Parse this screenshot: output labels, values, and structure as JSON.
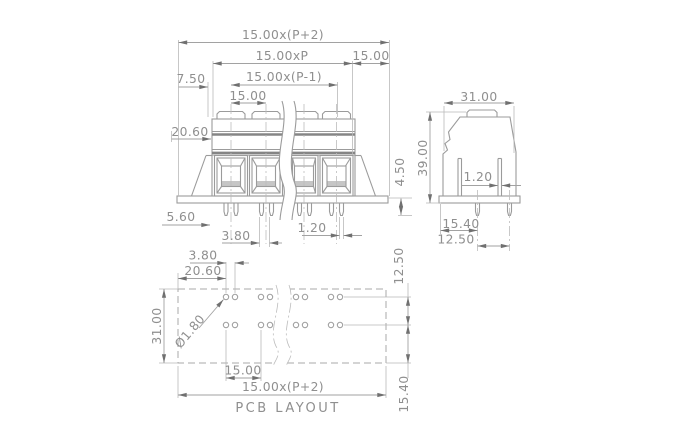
{
  "drawing": {
    "background_color": "#ffffff",
    "line_color": "#9b9b9b",
    "dim_line_color": "#a2a2a2",
    "text_color": "#8f8f8f",
    "arrow_color": "#707070",
    "front_view": {
      "dim_total_width": "15.00x(P+2)",
      "dim_pitch_span_all": "15.00xP",
      "dim_end_pitch": "15.00",
      "dim_half_pitch": "7.50",
      "dim_pitch_span_inner": "15.00x(P-1)",
      "dim_pitch": "15.00",
      "dim_body_offset": "20.60",
      "dim_flange_width": "5.60",
      "dim_pin_pair_spacing": "3.80",
      "dim_pin_thickness": "1.20",
      "dim_pin_length": "4.50"
    },
    "side_view": {
      "dim_depth": "31.00",
      "dim_height": "39.00",
      "dim_pin_thickness": "1.20",
      "dim_pin_row_offset": "15.40",
      "dim_pin_row_spacing": "12.50"
    },
    "pcb_layout": {
      "title": "PCB LAYOUT",
      "dim_hole_pair_spacing": "3.80",
      "dim_edge_to_first_hole": "20.60",
      "dim_hole_diameter": "Ø1.80",
      "dim_overall_depth": "31.00",
      "dim_row_spacing": "12.50",
      "dim_pitch": "15.00",
      "dim_total_width": "15.00x(P+2)",
      "dim_row_to_edge": "15.40"
    }
  }
}
